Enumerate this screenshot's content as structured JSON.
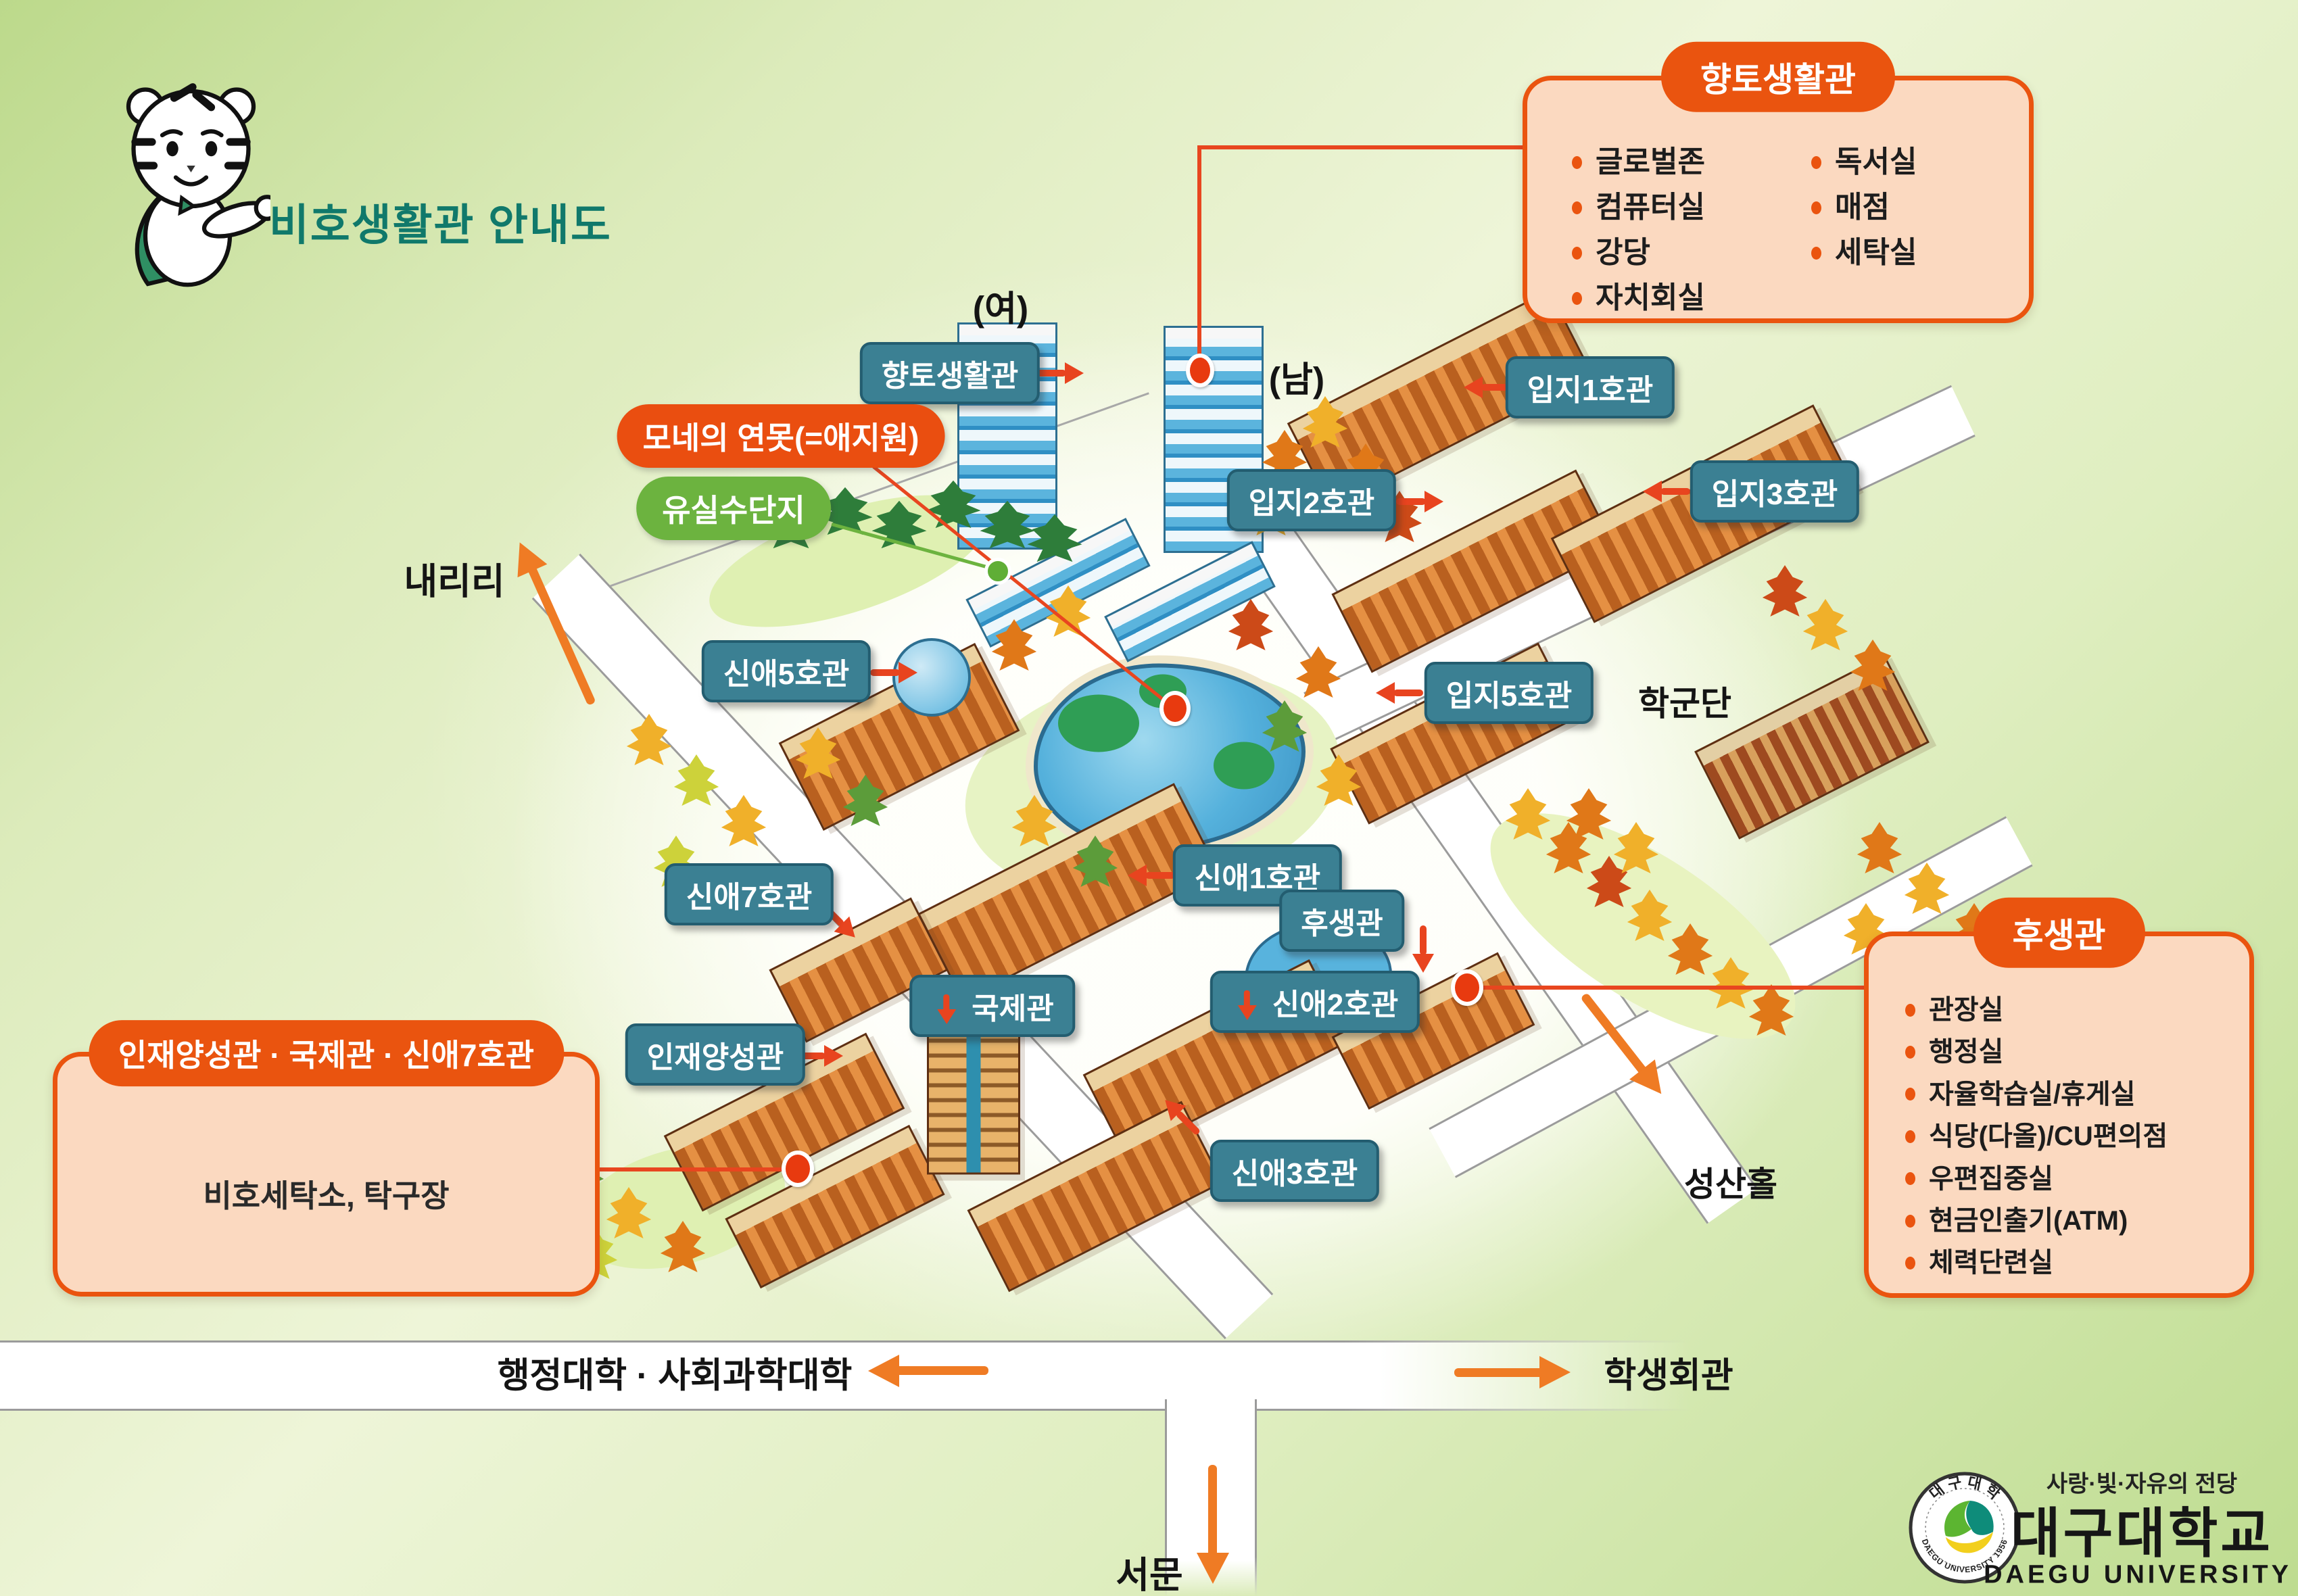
{
  "title": "비호생활관 안내도",
  "boxes": {
    "hyangto": {
      "title": "향토생활관",
      "items_left": [
        "글로벌존",
        "컴퓨터실",
        "강당",
        "자치회실"
      ],
      "items_right": [
        "독서실",
        "매점",
        "세탁실"
      ]
    },
    "huseang": {
      "title": "후생관",
      "items": [
        "관장실",
        "행정실",
        "자율학습실/휴게실",
        "식당(다올)/CU편의점",
        "우편집중실",
        "현금인출기(ATM)",
        "체력단련실"
      ]
    },
    "injae": {
      "title": "인재양성관 · 국제관 · 신애7호관",
      "content": "비호세탁소, 탁구장"
    }
  },
  "labels": {
    "hyangto": "향토생활관",
    "ipji1": "입지1호관",
    "ipji2": "입지2호관",
    "ipji3": "입지3호관",
    "ipji5": "입지5호관",
    "sinae1": "신애1호관",
    "sinae2": "신애2호관",
    "sinae3": "신애3호관",
    "sinae5": "신애5호관",
    "sinae7": "신애7호관",
    "huseang": "후생관",
    "gukje": "국제관",
    "injae": "인재양성관"
  },
  "pills": {
    "pond": "모네의 연못(=애지원)",
    "orchard": "유실수단지"
  },
  "places": {
    "female": "(여)",
    "male": "(남)",
    "naeriri": "내리리",
    "hakgundan": "학군단",
    "seongsanhall": "성산홀",
    "student_hall": "학생회관",
    "colleges": "행정대학 · 사회과학대학",
    "west_gate": "서문"
  },
  "logo": {
    "slogan": "사랑·빛·자유의 전당",
    "name_kr": "대구대학교",
    "name_en": "DAEGU UNIVERSITY",
    "seal_top": "대구대학",
    "seal_bottom": "DAEGU UNIVERSITY 1956"
  },
  "colors": {
    "accent_orange": "#ea540f",
    "label_teal": "#3b8093",
    "pill_green": "#6cb33f",
    "title_teal": "#10796b"
  }
}
